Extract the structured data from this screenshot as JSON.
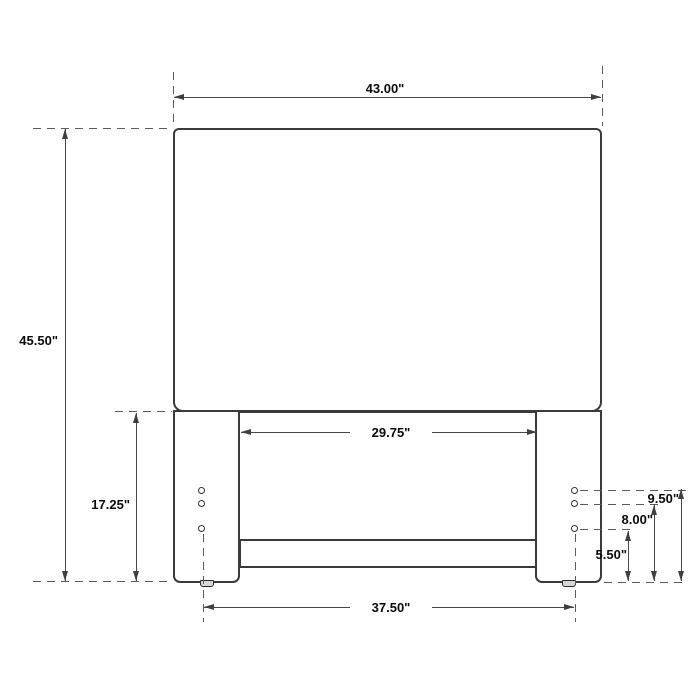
{
  "dims": {
    "overall_width": "43.00\"",
    "overall_height": "45.50\"",
    "leg_height": "17.25\"",
    "inner_width": "29.75\"",
    "hole_span": "37.50\"",
    "hole_top": "9.50\"",
    "hole_middle": "8.00\"",
    "hole_bottom": "5.50\""
  }
}
